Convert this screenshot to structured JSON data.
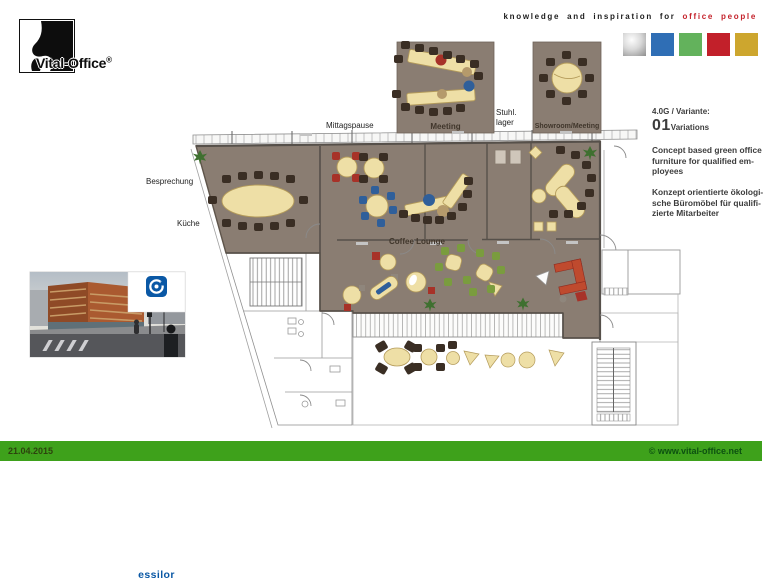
{
  "header": {
    "logo_name": "Vital-Office",
    "logo_reg": "®",
    "tagline_black": "knowledge and inspiration for",
    "tagline_red": "office people",
    "palette": [
      "silver-gradient",
      "#2f6eb5",
      "#63b25c",
      "#c2202a",
      "#cda62e"
    ]
  },
  "plan": {
    "labels": {
      "besprechung": "Besprechung",
      "kueche": "Küche",
      "mittagspause": "Mittagspause",
      "meeting": "Meeting",
      "stuhllager_line1": "Stuhl.",
      "stuhllager_line2": "lager",
      "showroom": "Showroom/Meeting",
      "coffee_lounge": "Coffee Lounge"
    }
  },
  "info": {
    "variant_label": "4.0G / Variante:",
    "variant_number": "01",
    "variant_word": "Variations",
    "concept_en": "Concept based green office furniture for qualified em­ployees",
    "concept_de": "Konzept orientierte ökologi­sche Büromöbel für qualifi­zierte Mitarbeiter"
  },
  "photo": {
    "brand": "essilor"
  },
  "footer": {
    "date": "21.04.2015",
    "website": "© www.vital-office.net"
  },
  "colors": {
    "floor": "#8a7d72",
    "table_cream": "#eedfa6",
    "chair_dark": "#3a2e24",
    "accent_red": "#a73228",
    "accent_blue": "#2f5f9a",
    "accent_green": "#7a9c3e",
    "footer_green": "#3ea11b",
    "brand_blue": "#0a58a5",
    "tagline_red": "#c4212a"
  }
}
